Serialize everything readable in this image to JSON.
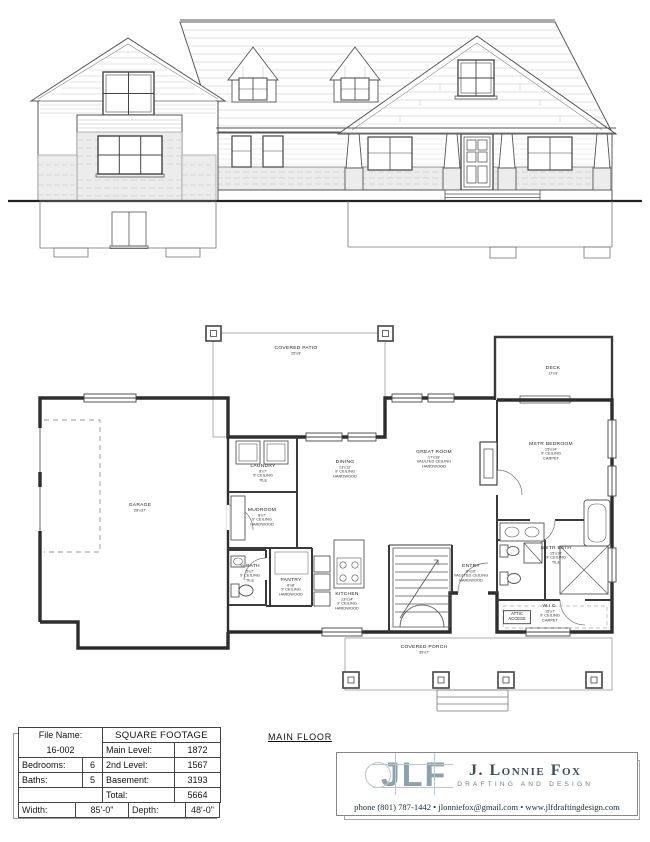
{
  "sheet": {
    "main_floor_label": "MAIN FLOOR"
  },
  "title_block": {
    "file_name_label": "File Name:",
    "file_name_value": "16-002",
    "square_footage_header": "SQUARE FOOTAGE",
    "main_level_label": "Main Level:",
    "main_level_value": "1872",
    "second_level_label": "2nd Level:",
    "second_level_value": "1567",
    "basement_label": "Basement:",
    "basement_value": "3193",
    "total_label": "Total:",
    "total_value": "5664",
    "bedrooms_label": "Bedrooms:",
    "bedrooms_value": "6",
    "baths_label": "Baths:",
    "baths_value": "5",
    "width_label": "Width:",
    "width_value": "85'-0\"",
    "depth_label": "Depth:",
    "depth_value": "48'-0\""
  },
  "branding": {
    "logo_text": "JLF",
    "company_name": "J. Lonnie Fox",
    "tagline": "DRAFTING AND DESIGN",
    "contact": "phone (801) 787-1442 • jlonniefox@gmail.com • www.jlfdraftingdesign.com",
    "logo_color": "#8da3ab"
  },
  "plan": {
    "rooms": [
      {
        "name": "GARAGE",
        "dims": "28'x37'"
      },
      {
        "name": "COVERED PATIO",
        "dims": "25'x9'"
      },
      {
        "name": "DECK",
        "dims": "17'x9'"
      },
      {
        "name": "LAUNDRY",
        "dims": "8'x7'",
        "ceiling": "9' CEILING",
        "floor": "TILE"
      },
      {
        "name": "DINING",
        "dims": "13'x12'",
        "ceiling": "9' CEILING",
        "floor": "HARDWOOD"
      },
      {
        "name": "GREAT ROOM",
        "dims": "17'x19'",
        "ceiling": "VAULTED CEILING",
        "floor": "HARDWOOD"
      },
      {
        "name": "MSTR BEDROOM",
        "dims": "15'x14'",
        "ceiling": "9' CEILING",
        "floor": "CARPET"
      },
      {
        "name": "MUDROOM",
        "dims": "8'x7'",
        "ceiling": "9' CEILING",
        "floor": "HARDWOOD"
      },
      {
        "name": "½ BATH",
        "dims": "5'x7'",
        "ceiling": "9' CEILING",
        "floor": "TILE"
      },
      {
        "name": "PANTRY",
        "dims": "6'x8'",
        "ceiling": "9' CEILING",
        "floor": "HARDWOOD"
      },
      {
        "name": "KITCHEN",
        "dims": "13'x14'",
        "ceiling": "9' CEILING",
        "floor": "HARDWOOD"
      },
      {
        "name": "ENTRY",
        "dims": "8'x10'",
        "ceiling": "VAULTED CEILING",
        "floor": "HARDWOOD"
      },
      {
        "name": "MSTR BATH",
        "dims": "15'x10'",
        "ceiling": "9' CEILING",
        "floor": "TILE"
      },
      {
        "name": "W.I.C.",
        "dims": "15'x7'",
        "ceiling": "9' CEILING",
        "floor": "CARPET"
      },
      {
        "name": "ATTIC ACCESS"
      },
      {
        "name": "COVERED PORCH",
        "dims": "39'x7'"
      }
    ]
  }
}
